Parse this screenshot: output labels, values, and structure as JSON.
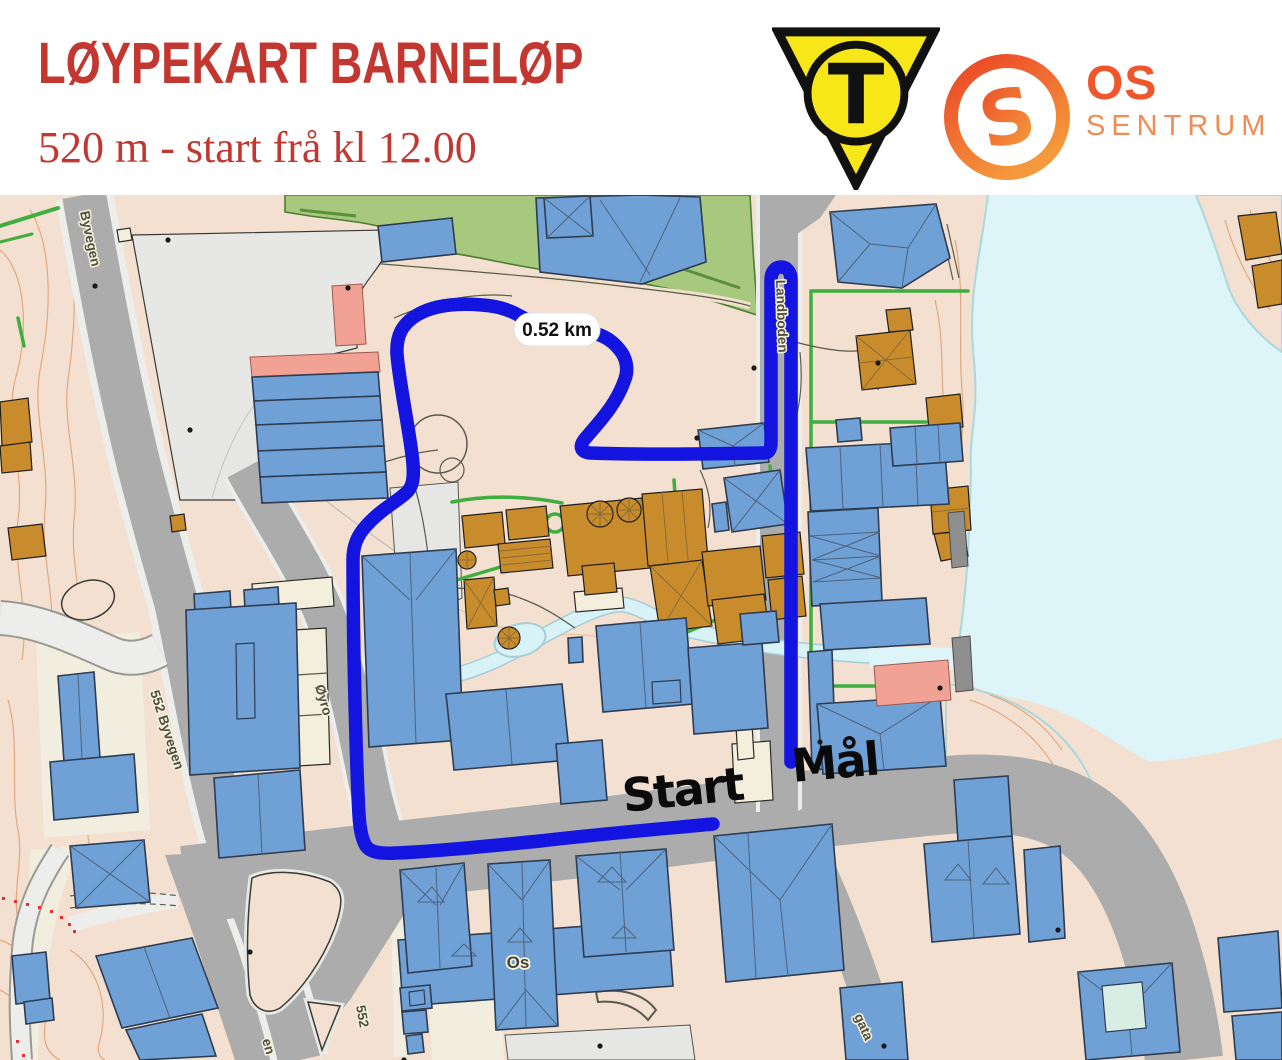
{
  "header": {
    "title": "LØYPEKART BARNELØP",
    "subtitle": "520 m - start frå kl 12.00",
    "club_logo_letter": "T",
    "os_logo": {
      "s_letter": "S",
      "line1": "OS",
      "line2": "SENTRUM"
    }
  },
  "map": {
    "distance_badge": "0.52 km",
    "start_label": "Start",
    "finish_label": "Mål",
    "street_labels": {
      "byvegen": "Byvegen",
      "byvegen552": "552 Byvegen",
      "oyro": "Øyro",
      "landboden": "Landboden",
      "road552": "552",
      "gata_partial": "gata",
      "en_partial": "en",
      "os_place": "Os"
    }
  },
  "colors": {
    "title_red": "#C23831",
    "route_blue": "#1414E0",
    "water": "#DDF5F8",
    "park_green": "#A7C97D",
    "road_gray": "#ACACAC",
    "building_blue": "#6FA1D6",
    "building_gold": "#C98C2D",
    "building_pink": "#F2A294",
    "building_cream": "#F3EFDC",
    "logo_yellow": "#F7E718",
    "logo_orange": "#EF5A26",
    "base_tan": "#F3E0D0"
  }
}
